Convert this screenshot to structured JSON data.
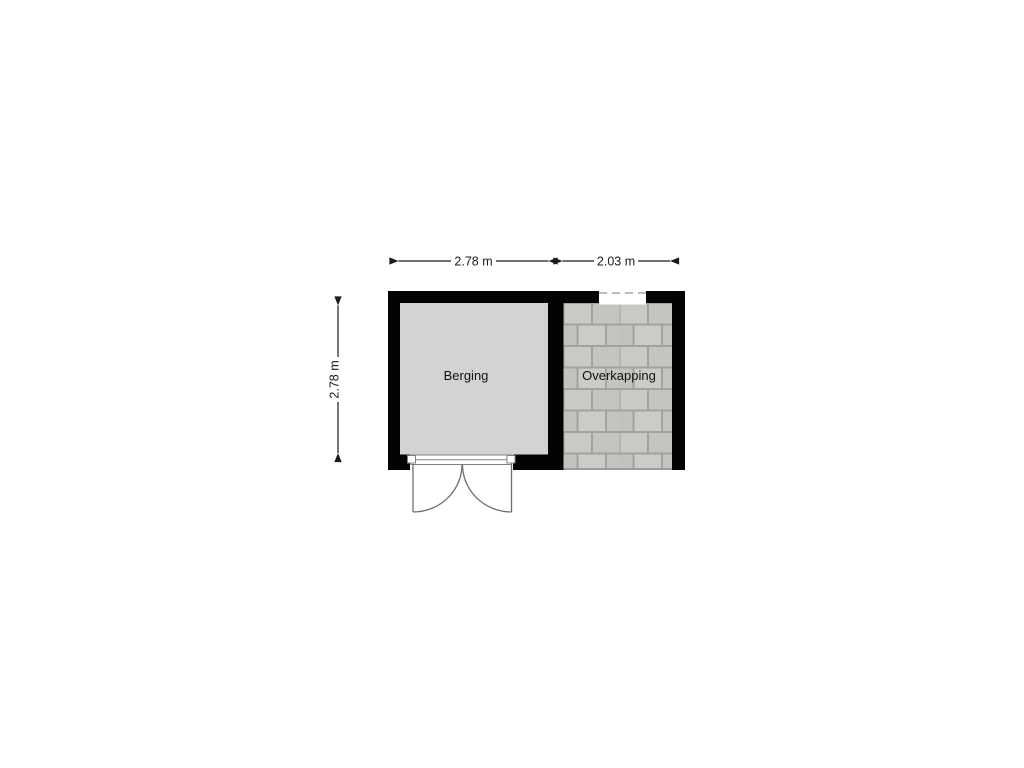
{
  "floorplan": {
    "rooms": [
      {
        "id": "berging",
        "label": "Berging"
      },
      {
        "id": "overkapping",
        "label": "Overkapping"
      }
    ],
    "dimensions": {
      "berging_width": "2.78 m",
      "overkapping_width": "2.03 m",
      "berging_height": "2.78 m"
    },
    "colors": {
      "background": "#ffffff",
      "wall": "#030303",
      "berging_floor": "#d3d3d3",
      "tile_joint": "#a2a29e",
      "tile_a": "#c9c9c5",
      "tile_b": "#c4c4c0",
      "tile_c": "#cbcbc7",
      "tile_d": "#c2c2be",
      "dimension": "#1a1a1a"
    }
  }
}
